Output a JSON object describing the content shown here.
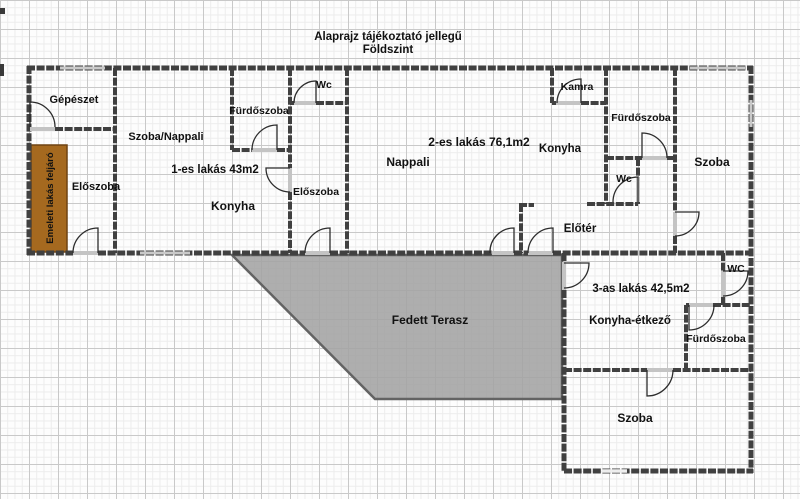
{
  "title": {
    "line1": "Alaprajz tájékoztató jellegű",
    "line2": "Földszint"
  },
  "common": {
    "gepeszet": "Gépészet",
    "eloszoba": "Előszoba",
    "stairs": "Emeleti lakás feljáró"
  },
  "apartment1": {
    "label": "1-es lakás 43m2",
    "rooms": {
      "szoba_nappali": "Szoba/Nappali",
      "furdoszoba": "Fürdőszoba",
      "wc": "Wc",
      "konyha": "Konyha",
      "eloszoba": "Előszoba"
    }
  },
  "apartment2": {
    "label": "2-es lakás 76,1m2",
    "rooms": {
      "nappali": "Nappali",
      "konyha": "Konyha",
      "kamra": "Kamra",
      "furdoszoba": "Fürdőszoba",
      "wc": "Wc",
      "szoba": "Szoba",
      "eloter": "Előtér"
    }
  },
  "apartment3": {
    "label": "3-as lakás 42,5m2",
    "rooms": {
      "konyha_etkezo": "Konyha-étkező",
      "wc": "WC",
      "furdoszoba": "Fürdőszoba",
      "szoba": "Szoba"
    }
  },
  "terrace": {
    "label": "Fedett Terasz"
  },
  "colors": {
    "stairs_fill": "#a5691f",
    "terrace_fill": "#a3a3a3",
    "wall": "#404040"
  }
}
